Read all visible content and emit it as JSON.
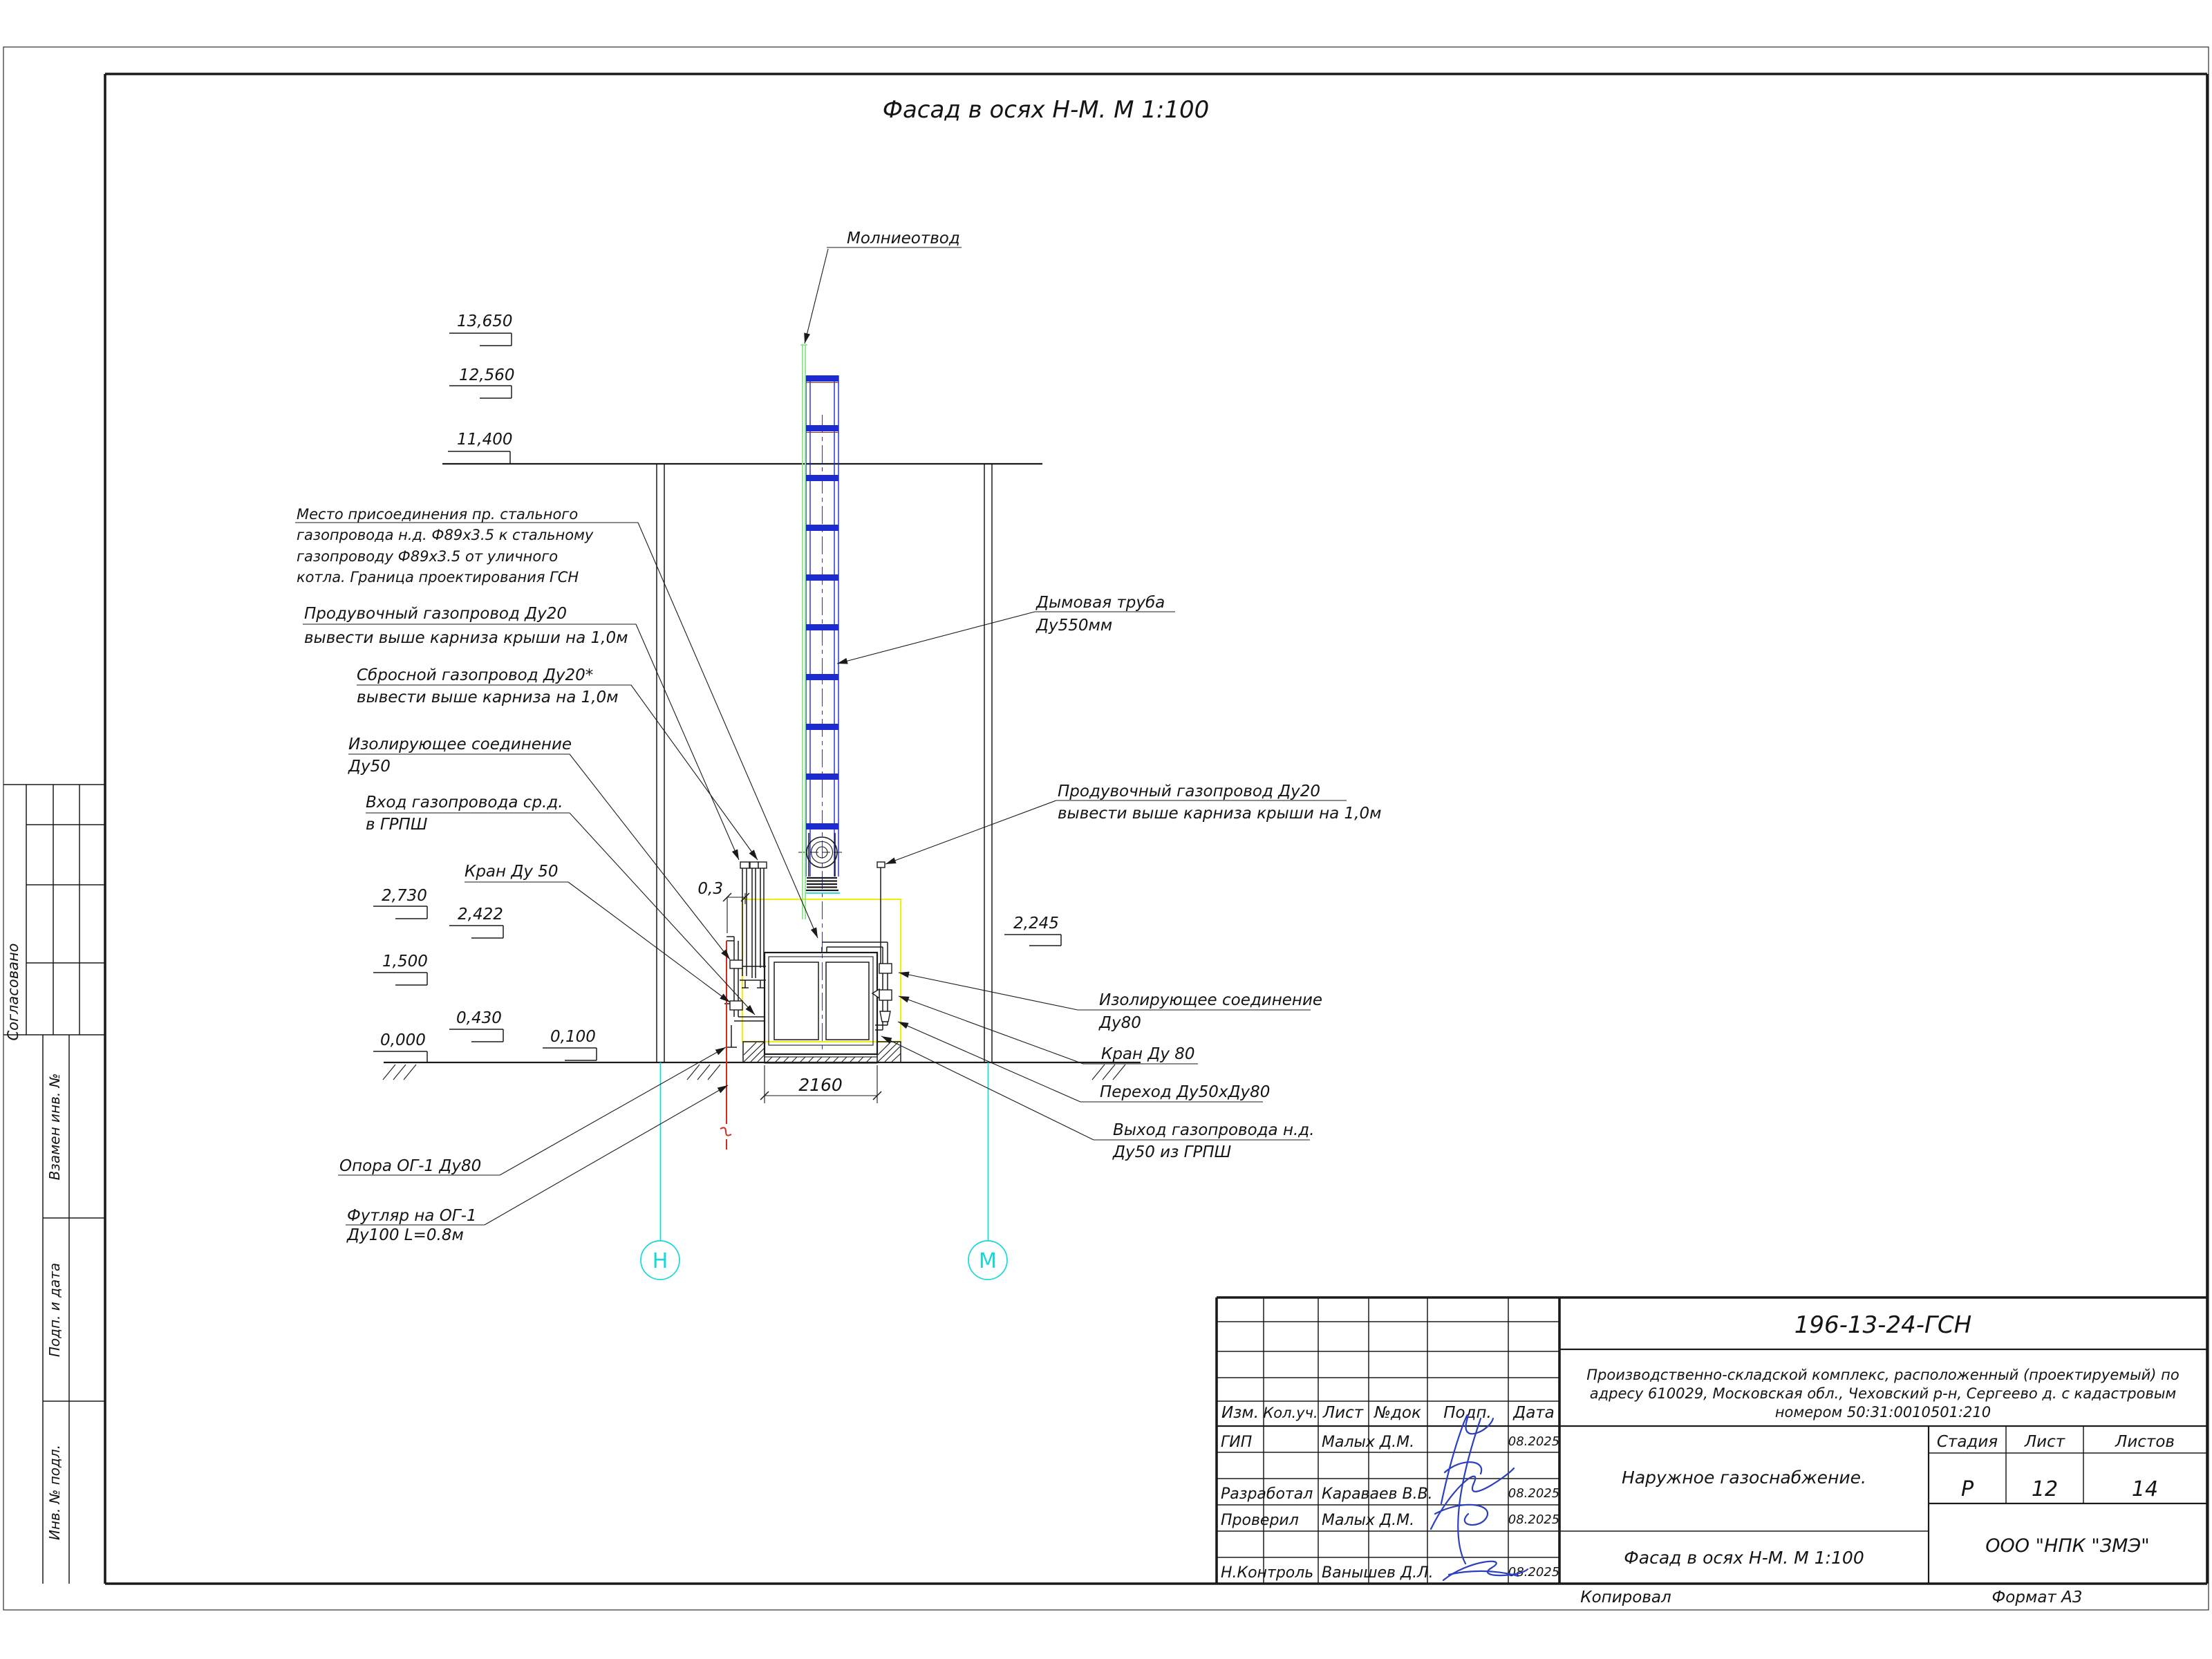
{
  "sheet": {
    "title": "Фасад в осях Н-М. М 1:100",
    "copied_label": "Копировал",
    "format_label": "Формат А3"
  },
  "sidebar": {
    "approved_label": "Согласовано",
    "replace_inv_label": "Взамен инв. №",
    "sign_date_label": "Подп. и дата",
    "inv_orig_label": "Инв. № подл."
  },
  "axes": {
    "left": "Н",
    "right": "М"
  },
  "elevations": {
    "top": [
      "13,650",
      "12,560",
      "11,400"
    ],
    "left": [
      "2,730",
      "2,422",
      "1,500",
      "0,430",
      "0,000",
      "0,100"
    ],
    "right": "2,245"
  },
  "dimensions": {
    "width": "2160",
    "offset": "0,3"
  },
  "callouts": {
    "lightning": "Молниеотвод",
    "connection_1": "Место присоединения пр. стального",
    "connection_2": "газопровода н.д. Ф89х3.5 к стальному",
    "connection_3": "газопроводу Ф89х3.5 от уличного",
    "connection_4": "котла. Граница проектирования ГСН",
    "purge_left_1": "Продувочный газопровод Ду20",
    "purge_left_2": "вывести выше карниза крыши на 1,0м",
    "relief_1": "Сбросной газопровод Ду20*",
    "relief_2": "вывести выше карниза на 1,0м",
    "insulating50_1": "Изолирующее соединение",
    "insulating50_2": "Ду50",
    "inlet_1": "Вход газопровода ср.д.",
    "inlet_2": "в ГРПШ",
    "valve50": "Кран Ду 50",
    "chimney_1": "Дымовая труба",
    "chimney_2": "Ду550мм",
    "purge_right_1": "Продувочный газопровод Ду20",
    "purge_right_2": "вывести выше карниза крыши на 1,0м",
    "insulating80_1": "Изолирующее соединение",
    "insulating80_2": "Ду80",
    "valve80": "Кран Ду 80",
    "reducer": "Переход Ду50хДу80",
    "outlet_1": "Выход газопровода н.д.",
    "outlet_2": "Ду50 из ГРПШ",
    "support": "Опора ОГ-1 Ду80",
    "casing_1": "Футляр на ОГ-1",
    "casing_2": "Ду100 L=0.8м"
  },
  "title_block": {
    "doc_number": "196-13-24-ГСН",
    "project_line_1": "Производственно-складской комплекс, расположенный (проектируемый) по",
    "project_line_2": "адресу 610029, Московская обл., Чеховский р-н, Сергеево д. с кадастровым",
    "project_line_3": "номером 50:31:0010501:210",
    "object_name": "Наружное газоснабжение.",
    "drawing_name": "Фасад в осях Н-М. М 1:100",
    "organization": "ООО \"НПК \"ЗМЭ\"",
    "headers": {
      "izm": "Изм.",
      "kol": "Кол.уч.",
      "list": "Лист",
      "doc": "№док",
      "sign": "Подп.",
      "date": "Дата"
    },
    "stage_label": "Стадия",
    "sheet_label": "Лист",
    "sheets_label": "Листов",
    "stage": "Р",
    "sheet": "12",
    "sheets": "14",
    "rows": [
      {
        "role": "ГИП",
        "name": "Малых Д.М.",
        "date": "08.2025"
      },
      {
        "role": "Разработал",
        "name": "Караваев В.В.",
        "date": "08.2025"
      },
      {
        "role": "Проверил",
        "name": "Малых Д.М.",
        "date": "08.2025"
      },
      {
        "role": "Н.Контроль",
        "name": "Ванышев Д.Л.",
        "date": "08.2025"
      }
    ]
  },
  "colors": {
    "chimney_blue": "#1c2bd0",
    "axis_cyan": "#17d8d8",
    "lightning_green": "#8ce68c",
    "boundary_yellow": "#f0ed1a",
    "underground_red": "#d42b1e",
    "signature_blue": "#2b3fc0"
  }
}
